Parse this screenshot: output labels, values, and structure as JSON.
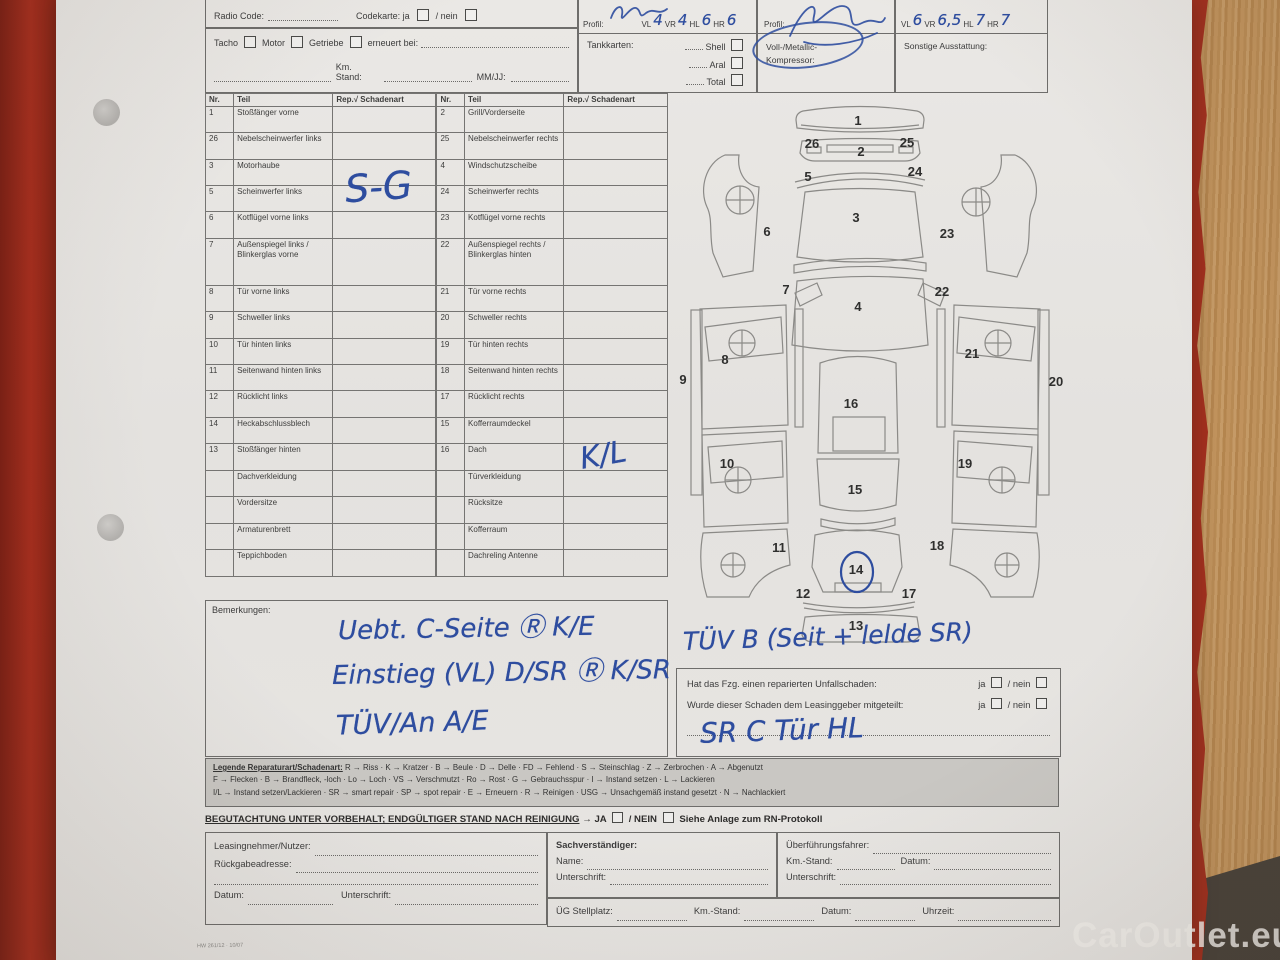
{
  "colors": {
    "folder_red": "#a72e1e",
    "wood": "#bb8d55",
    "paper": "#e7e5e2",
    "ink_blue": "#2e4d9f",
    "floor": "#49423a"
  },
  "watermark": "CarOutlet.eu",
  "header": {
    "boxA": {
      "radio": "Radio Code:",
      "codekarte": "Codekarte: ja",
      "nein": "/ nein",
      "tacho": "Tacho",
      "motor": "Motor",
      "getriebe": "Getriebe",
      "erneuert": "erneuert bei:",
      "km": "Km. Stand:",
      "mmjj": "MM/JJ:"
    },
    "boxB": {
      "profil": "Profil:",
      "wheels": [
        "VL",
        "VR",
        "HL",
        "HR"
      ],
      "values": [
        "4",
        "4",
        "6",
        "6"
      ],
      "tank": "Tankkarten:",
      "cards": [
        "Shell",
        "Aral",
        "Total"
      ]
    },
    "boxC": {
      "profil": "Profil:",
      "lack1": "Voll-/Metallic-",
      "lack2": "Kompressor:"
    },
    "boxD": {
      "wheels": [
        "VL",
        "VR",
        "HL",
        "HR"
      ],
      "values": [
        "6",
        "6,5",
        "7",
        "7"
      ],
      "sonstige": "Sonstige Ausstattung:"
    }
  },
  "damage_table": {
    "headers": {
      "nr": "Nr.",
      "teil": "Teil",
      "rep": "Rep.√ Schadenart"
    },
    "rows": [
      {
        "nl": "1",
        "tl": "Stoßfänger vorne",
        "rl": "",
        "nr": "2",
        "tr": "Grill/Vorder­seite",
        "rr": ""
      },
      {
        "nl": "26",
        "tl": "Nebelschein­werfer links",
        "rl": "",
        "nr": "25",
        "tr": "Nebelschein­werfer rechts",
        "rr": ""
      },
      {
        "nl": "3",
        "tl": "Motorhaube",
        "rl": "",
        "nr": "4",
        "tr": "Windschutz­scheibe",
        "rr": ""
      },
      {
        "nl": "5",
        "tl": "Scheinwerfer links",
        "rl": "",
        "nr": "24",
        "tr": "Scheinwerfer rechts",
        "rr": ""
      },
      {
        "nl": "6",
        "tl": "Kotflügel vorne links",
        "rl": "",
        "nr": "23",
        "tr": "Kotflügel vorne rechts",
        "rr": ""
      },
      {
        "nl": "7",
        "tl": "Außenspiegel links / Blinkerglas vorne",
        "rl": "",
        "nr": "22",
        "tr": "Außenspiegel rechts / Blinkerglas hinten",
        "rr": ""
      },
      {
        "nl": "8",
        "tl": "Tür vorne links",
        "rl": "",
        "nr": "21",
        "tr": "Tür vorne rechts",
        "rr": ""
      },
      {
        "nl": "9",
        "tl": "Schweller links",
        "rl": "",
        "nr": "20",
        "tr": "Schweller rechts",
        "rr": ""
      },
      {
        "nl": "10",
        "tl": "Tür hinten links",
        "rl": "",
        "nr": "19",
        "tr": "Tür hinten rechts",
        "rr": ""
      },
      {
        "nl": "11",
        "tl": "Seitenwand hinten links",
        "rl": "",
        "nr": "18",
        "tr": "Seitenwand hinten rechts",
        "rr": ""
      },
      {
        "nl": "12",
        "tl": "Rücklicht links",
        "rl": "",
        "nr": "17",
        "tr": "Rücklicht rechts",
        "rr": ""
      },
      {
        "nl": "14",
        "tl": "Heckabschluss­blech",
        "rl": "",
        "nr": "15",
        "tr": "Kofferraum­deckel",
        "rr": ""
      },
      {
        "nl": "13",
        "tl": "Stoßfänger hinten",
        "rl": "",
        "nr": "16",
        "tr": "Dach",
        "rr": ""
      },
      {
        "nl": "",
        "tl": "Dachverkleidung",
        "rl": "",
        "nr": "",
        "tr": "Türverkleidung",
        "rr": ""
      },
      {
        "nl": "",
        "tl": "Vordersitze",
        "rl": "",
        "nr": "",
        "tr": "Rücksitze",
        "rr": ""
      },
      {
        "nl": "",
        "tl": "Armaturenbrett",
        "rl": "",
        "nr": "",
        "tr": "Kofferraum",
        "rr": ""
      },
      {
        "nl": "",
        "tl": "Teppichboden",
        "rl": "",
        "nr": "",
        "tr": "Dachreling Antenne",
        "rr": ""
      }
    ]
  },
  "pen": {
    "sg": "S-G",
    "kl": "K/L",
    "diagram_note": "TÜV B (Seit + lelde SR)",
    "answer_note": "SR C Tür HL"
  },
  "bemerkungen": {
    "label": "Bemerkungen:",
    "lines": [
      "Uebt. C-Seite Ⓡ K/E",
      "Einstieg (VL) D/SR Ⓡ K/SR",
      "TÜV/An A/E"
    ]
  },
  "diagram": {
    "numbers": [
      {
        "n": "1",
        "x": 183,
        "y": 30
      },
      {
        "n": "26",
        "x": 137,
        "y": 53
      },
      {
        "n": "2",
        "x": 186,
        "y": 61
      },
      {
        "n": "25",
        "x": 232,
        "y": 52
      },
      {
        "n": "5",
        "x": 133,
        "y": 86
      },
      {
        "n": "24",
        "x": 240,
        "y": 81
      },
      {
        "n": "3",
        "x": 181,
        "y": 127
      },
      {
        "n": "6",
        "x": 92,
        "y": 141
      },
      {
        "n": "23",
        "x": 272,
        "y": 143
      },
      {
        "n": "7",
        "x": 111,
        "y": 199
      },
      {
        "n": "22",
        "x": 267,
        "y": 201
      },
      {
        "n": "4",
        "x": 183,
        "y": 216
      },
      {
        "n": "8",
        "x": 50,
        "y": 269
      },
      {
        "n": "21",
        "x": 297,
        "y": 263
      },
      {
        "n": "9",
        "x": 8,
        "y": 289
      },
      {
        "n": "20",
        "x": 381,
        "y": 291
      },
      {
        "n": "10",
        "x": 52,
        "y": 373
      },
      {
        "n": "19",
        "x": 290,
        "y": 373
      },
      {
        "n": "16",
        "x": 176,
        "y": 313
      },
      {
        "n": "15",
        "x": 180,
        "y": 399
      },
      {
        "n": "11",
        "x": 104,
        "y": 457
      },
      {
        "n": "18",
        "x": 262,
        "y": 455
      },
      {
        "n": "14",
        "x": 181,
        "y": 479
      },
      {
        "n": "12",
        "x": 128,
        "y": 503
      },
      {
        "n": "17",
        "x": 234,
        "y": 503
      },
      {
        "n": "13",
        "x": 181,
        "y": 535
      }
    ]
  },
  "questions": {
    "q1": "Hat das Fzg. einen reparierten Unfallschaden:",
    "q2": "Wurde dieser Schaden dem Leasinggeber mitgeteilt:",
    "ja": "ja",
    "nein": "/ nein"
  },
  "legend": {
    "title": "Legende Reparaturart/Schadenart:",
    "lines": [
      "R → Riss · K → Kratzer · B → Beule · D → Delle · FD → Fehlend · S → Steinschlag · Z → Zerbrochen · A → Abgenutzt",
      "F → Flecken · B → Brandfleck, -loch · Lo → Loch · VS → Verschmutzt · Ro → Rost · G → Gebrauchsspur · I → Instand setzen · L → Lackieren",
      "I/L → Instand setzen/Lackieren · SR → smart repair · SP → spot repair · E → Erneuern · R → Reinigen · USG → Unsachgemäß instand gesetzt · N → Nachlackiert"
    ]
  },
  "vorbehalt": {
    "main": "BEGUTACHTUNG UNTER VORBEHALT; ENDGÜLTIGER STAND NACH REINIGUNG",
    "arrow": "→",
    "ja": "JA",
    "nein": "/ NEIN",
    "rest": "Siehe Anlage zum RN-Protokoll"
  },
  "footer": {
    "col1": {
      "l1": "Leasingnehmer/Nutzer:",
      "l2": "Rückgabeadresse:",
      "datum": "Datum:",
      "unterschrift": "Unterschrift:"
    },
    "col2": {
      "title": "Sachverständiger:",
      "name": "Name:",
      "unterschrift": "Unterschrift:"
    },
    "col3": {
      "fahrer": "Überführungsfahrer:",
      "km": "Km.-Stand:",
      "datum": "Datum:",
      "unterschrift": "Unterschrift:"
    },
    "bottom": {
      "stellplatz": "ÜG Stellplatz:",
      "km": "Km.-Stand:",
      "datum": "Datum:",
      "uhrzeit": "Uhrzeit:"
    },
    "form_code": "HW 261/12 · 10/07"
  }
}
